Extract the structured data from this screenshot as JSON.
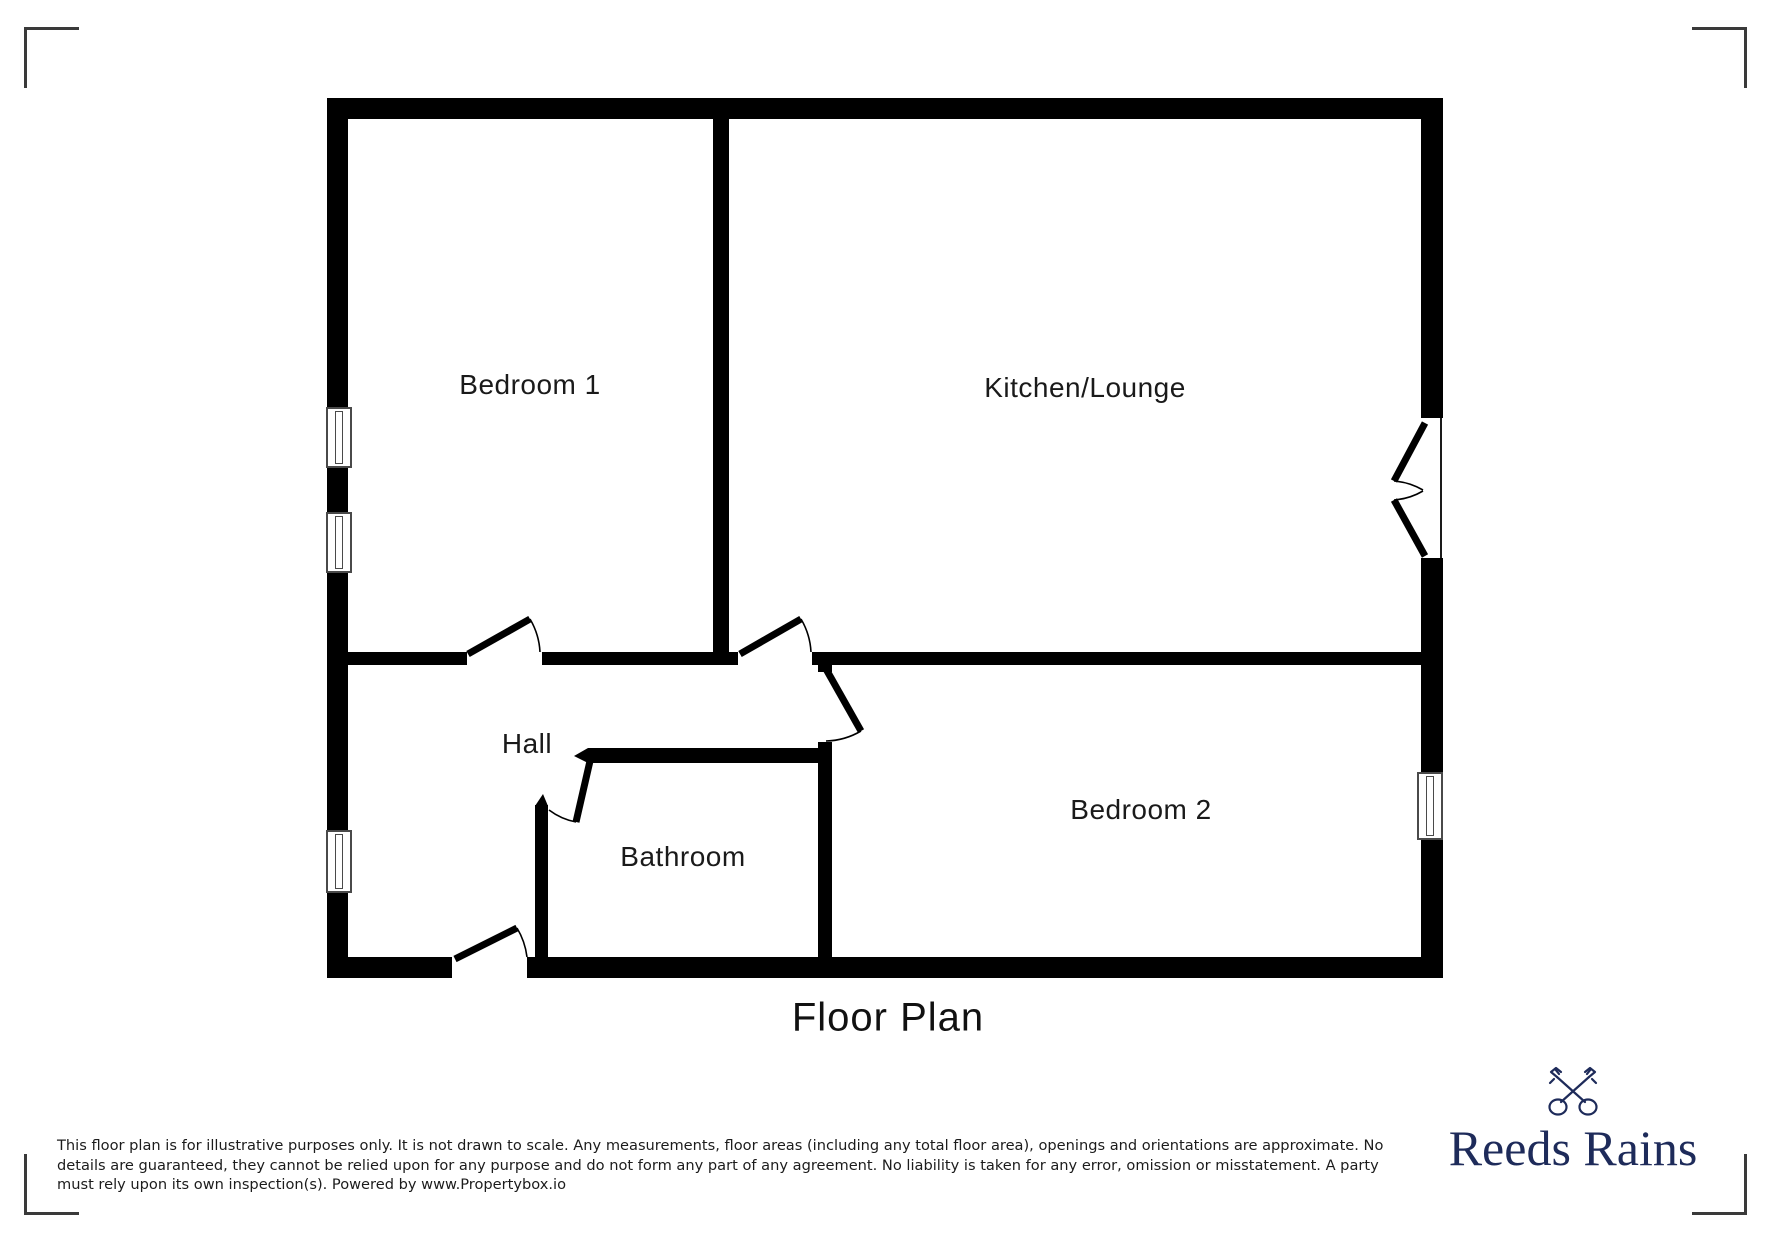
{
  "plan": {
    "title": "Floor Plan",
    "rooms": {
      "bedroom1": "Bedroom 1",
      "kitchen_lounge": "Kitchen/Lounge",
      "hall": "Hall",
      "bathroom": "Bathroom",
      "bedroom2": "Bedroom 2"
    }
  },
  "disclaimer": {
    "lines": [
      "This floor plan is for illustrative purposes only. It is not drawn to scale. Any measurements, floor areas (including any total floor area), openings and orientations are approximate. No",
      "details are guaranteed, they cannot be relied upon for any purpose and do not form any part of any agreement. No liability is taken for any error, omission or misstatement. A party",
      "must rely upon its own inspection(s). Powered by www.Propertybox.io"
    ]
  },
  "logo": {
    "name": "Reeds Rains",
    "icon": "crossed-keys-icon"
  },
  "colors": {
    "wall": "#000000",
    "window_frame": "#4a4a4a",
    "corner_mark": "#3a3a3a",
    "logo_navy": "#1e2b5a"
  }
}
